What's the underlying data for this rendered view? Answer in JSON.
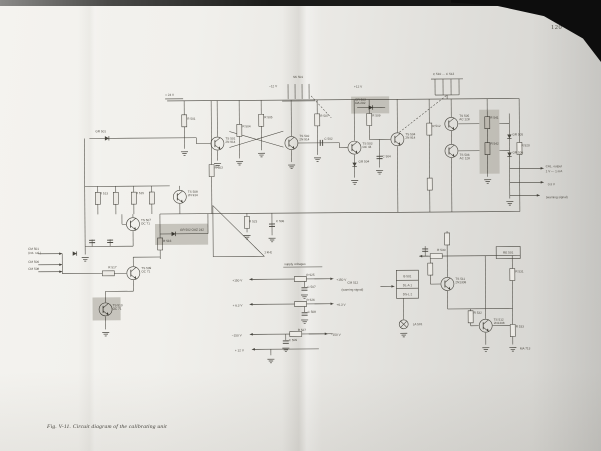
{
  "page_number": "120",
  "caption": "Fig. V-11. Circuit diagram of the calibrating unit",
  "colors": {
    "paper": "#eceae5",
    "ink": "#45433c",
    "label": "#4c4941",
    "highlight": "#b3b0a8"
  },
  "schematic": {
    "wires": [
      [
        168,
        100,
        520,
        100
      ],
      [
        185,
        100,
        185,
        148
      ],
      [
        212,
        100,
        212,
        213
      ],
      [
        240,
        100,
        240,
        158
      ],
      [
        262,
        100,
        262,
        150
      ],
      [
        292,
        100,
        292,
        136
      ],
      [
        292,
        150,
        292,
        162
      ],
      [
        318,
        100,
        318,
        155
      ],
      [
        355,
        100,
        355,
        141
      ],
      [
        355,
        155,
        355,
        178
      ],
      [
        370,
        100,
        370,
        140
      ],
      [
        370,
        140,
        391,
        140
      ],
      [
        398,
        100,
        398,
        133
      ],
      [
        398,
        147,
        398,
        213
      ],
      [
        430,
        100,
        430,
        213
      ],
      [
        452,
        100,
        452,
        118
      ],
      [
        452,
        132,
        452,
        145
      ],
      [
        452,
        159,
        452,
        213
      ],
      [
        488,
        100,
        488,
        112
      ],
      [
        488,
        112,
        488,
        178
      ],
      [
        520,
        100,
        520,
        213
      ],
      [
        218,
        100,
        218,
        136
      ],
      [
        218,
        150,
        218,
        160
      ],
      [
        197,
        137,
        197,
        143
      ],
      [
        197,
        143,
        211,
        143
      ],
      [
        90,
        137,
        197,
        137
      ],
      [
        85,
        137,
        85,
        253
      ],
      [
        230,
        131,
        284,
        147
      ],
      [
        230,
        147,
        284,
        131
      ],
      [
        298,
        143,
        340,
        143
      ],
      [
        340,
        143,
        340,
        148
      ],
      [
        340,
        148,
        348,
        148
      ],
      [
        380,
        140,
        380,
        168
      ],
      [
        459,
        125,
        480,
        125
      ],
      [
        459,
        152,
        480,
        152
      ],
      [
        500,
        125,
        510,
        125
      ],
      [
        500,
        152,
        510,
        152
      ],
      [
        510,
        115,
        510,
        200
      ],
      [
        289,
        84,
        289,
        99
      ],
      [
        296,
        84,
        296,
        99
      ],
      [
        303,
        84,
        303,
        99
      ],
      [
        310,
        84,
        310,
        99
      ],
      [
        283,
        101,
        316,
        101
      ],
      [
        432,
        80,
        464,
        80
      ],
      [
        436,
        80,
        436,
        96
      ],
      [
        444,
        80,
        444,
        96
      ],
      [
        452,
        80,
        452,
        96
      ],
      [
        460,
        80,
        460,
        96
      ],
      [
        436,
        96,
        460,
        96
      ],
      [
        448,
        96,
        448,
        100
      ],
      [
        166,
        98,
        184,
        98
      ],
      [
        358,
        108,
        386,
        108
      ],
      [
        160,
        213,
        520,
        213
      ],
      [
        85,
        185,
        170,
        185
      ],
      [
        98,
        185,
        98,
        213
      ],
      [
        116,
        185,
        116,
        213
      ],
      [
        134,
        185,
        134,
        213
      ],
      [
        152,
        185,
        152,
        213
      ],
      [
        180,
        185,
        180,
        189
      ],
      [
        180,
        203,
        180,
        213
      ],
      [
        122,
        213,
        122,
        223
      ],
      [
        122,
        223,
        126,
        223
      ],
      [
        133,
        213,
        133,
        216
      ],
      [
        133,
        230,
        133,
        245
      ],
      [
        85,
        245,
        133,
        245
      ],
      [
        92,
        238,
        92,
        245
      ],
      [
        110,
        238,
        110,
        245
      ],
      [
        160,
        213,
        160,
        258
      ],
      [
        160,
        233,
        208,
        233
      ],
      [
        208,
        213,
        208,
        233
      ],
      [
        133,
        256,
        133,
        265
      ],
      [
        133,
        256,
        160,
        256
      ],
      [
        100,
        272,
        126,
        272
      ],
      [
        62,
        252,
        62,
        272
      ],
      [
        62,
        272,
        100,
        272
      ],
      [
        133,
        279,
        133,
        290
      ],
      [
        105,
        290,
        133,
        290
      ],
      [
        105,
        290,
        105,
        301
      ],
      [
        105,
        315,
        105,
        328
      ],
      [
        247,
        213,
        247,
        232
      ],
      [
        272,
        213,
        272,
        235
      ],
      [
        250,
        279,
        332,
        279
      ],
      [
        250,
        304,
        332,
        304
      ],
      [
        250,
        334,
        332,
        334
      ],
      [
        252,
        349,
        318,
        349
      ],
      [
        304,
        279,
        304,
        287
      ],
      [
        304,
        304,
        304,
        312
      ],
      [
        285,
        334,
        285,
        340
      ],
      [
        270,
        349,
        270,
        355
      ],
      [
        283,
        267,
        322,
        267
      ],
      [
        396,
        281,
        418,
        281
      ],
      [
        396,
        289,
        418,
        289
      ],
      [
        403,
        299,
        403,
        320
      ],
      [
        420,
        257,
        520,
        257
      ],
      [
        447,
        232,
        447,
        257
      ],
      [
        447,
        257,
        447,
        278
      ],
      [
        447,
        292,
        447,
        310
      ],
      [
        447,
        310,
        512,
        310
      ],
      [
        430,
        257,
        430,
        285
      ],
      [
        430,
        285,
        440,
        285
      ],
      [
        485,
        257,
        485,
        320
      ],
      [
        485,
        334,
        485,
        346
      ],
      [
        470,
        310,
        470,
        327
      ],
      [
        470,
        327,
        478,
        327
      ],
      [
        492,
        327,
        512,
        327
      ],
      [
        512,
        257,
        512,
        346
      ],
      [
        425,
        247,
        425,
        257
      ]
    ],
    "dashes": [
      [
        312,
        96,
        332,
        118
      ],
      [
        400,
        133,
        448,
        96
      ]
    ],
    "arrows": [
      [
        38,
        252,
        62,
        252
      ],
      [
        38,
        263,
        62,
        263
      ],
      [
        38,
        270,
        62,
        270
      ],
      [
        510,
        170,
        544,
        170
      ],
      [
        510,
        184,
        544,
        184
      ],
      [
        510,
        197,
        540,
        197
      ],
      [
        268,
        279,
        249,
        279
      ],
      [
        268,
        304,
        249,
        304
      ],
      [
        268,
        334,
        249,
        334
      ],
      [
        264,
        349,
        251,
        349
      ],
      [
        314,
        279,
        333,
        279
      ],
      [
        314,
        304,
        333,
        304
      ],
      [
        308,
        334,
        327,
        334
      ],
      [
        380,
        287,
        394,
        287
      ],
      [
        428,
        257,
        419,
        257
      ]
    ],
    "resistors": [
      [
        185,
        120,
        "v"
      ],
      [
        212,
        170,
        "v"
      ],
      [
        240,
        130,
        "v"
      ],
      [
        262,
        120,
        "v"
      ],
      [
        318,
        120,
        "v"
      ],
      [
        370,
        120,
        "v"
      ],
      [
        430,
        130,
        "v"
      ],
      [
        430,
        185,
        "v"
      ],
      [
        488,
        124,
        "v"
      ],
      [
        488,
        150,
        "v"
      ],
      [
        520,
        150,
        "v"
      ],
      [
        98,
        197,
        "v"
      ],
      [
        116,
        197,
        "v"
      ],
      [
        134,
        197,
        "v"
      ],
      [
        152,
        197,
        "v"
      ],
      [
        160,
        243,
        "v"
      ],
      [
        108,
        272,
        "h"
      ],
      [
        300,
        279,
        "h"
      ],
      [
        300,
        304,
        "h"
      ],
      [
        295,
        334,
        "h"
      ],
      [
        436,
        257,
        "h"
      ],
      [
        430,
        270,
        "v"
      ],
      [
        447,
        240,
        "v"
      ],
      [
        470,
        318,
        "v"
      ],
      [
        512,
        276,
        "v"
      ],
      [
        512,
        332,
        "v"
      ],
      [
        247,
        222,
        "v"
      ]
    ],
    "caps": [
      [
        322,
        143,
        "h"
      ],
      [
        380,
        158,
        "v"
      ],
      [
        272,
        225,
        "v"
      ],
      [
        92,
        240,
        "v"
      ],
      [
        110,
        240,
        "v"
      ],
      [
        304,
        289,
        "v"
      ],
      [
        304,
        314,
        "v"
      ],
      [
        285,
        342,
        "v"
      ],
      [
        425,
        251,
        "v"
      ]
    ],
    "diodes": [
      [
        108,
        137,
        "r"
      ],
      [
        372,
        108,
        "r"
      ],
      [
        355,
        165,
        "d"
      ],
      [
        510,
        138,
        "d"
      ],
      [
        510,
        156,
        "d"
      ],
      [
        174,
        233,
        "r"
      ],
      [
        75,
        252,
        "r"
      ]
    ],
    "transistors": [
      [
        218,
        143
      ],
      [
        292,
        143
      ],
      [
        355,
        148
      ],
      [
        398,
        140
      ],
      [
        452,
        125
      ],
      [
        452,
        152
      ],
      [
        133,
        223
      ],
      [
        180,
        196
      ],
      [
        133,
        272
      ],
      [
        105,
        308
      ],
      [
        447,
        285
      ],
      [
        485,
        327
      ]
    ],
    "grounds": [
      [
        185,
        151
      ],
      [
        218,
        163
      ],
      [
        240,
        161
      ],
      [
        262,
        153
      ],
      [
        292,
        165
      ],
      [
        318,
        158
      ],
      [
        355,
        181
      ],
      [
        380,
        171
      ],
      [
        488,
        181
      ],
      [
        510,
        203
      ],
      [
        85,
        256
      ],
      [
        105,
        331
      ],
      [
        247,
        235
      ],
      [
        272,
        238
      ],
      [
        304,
        295
      ],
      [
        304,
        320
      ],
      [
        285,
        348
      ],
      [
        270,
        359
      ],
      [
        403,
        334
      ],
      [
        485,
        349
      ],
      [
        512,
        349
      ]
    ],
    "lamps": [
      [
        403,
        325
      ]
    ],
    "boxes": [
      [
        396,
        271,
        22,
        28
      ],
      [
        496,
        248,
        24,
        12
      ]
    ],
    "triangle": "213,205 213,256 264,256",
    "highlights": [
      [
        352,
        97,
        38,
        17
      ],
      [
        480,
        111,
        20,
        64
      ],
      [
        155,
        223,
        53,
        21
      ],
      [
        92,
        296,
        28,
        23
      ]
    ],
    "labels": [
      [
        166,
        95,
        "+ 24 V"
      ],
      [
        96,
        131,
        "GR 501"
      ],
      [
        294,
        78,
        "SK 501"
      ],
      [
        270,
        87,
        "−12 V"
      ],
      [
        355,
        88,
        "+12 V"
      ],
      [
        434,
        76,
        "C 510 … C 513"
      ],
      [
        226,
        139,
        "TS 501\n2N 914"
      ],
      [
        300,
        137,
        "TS 502\n2N 914"
      ],
      [
        363,
        145,
        "TS 503\nOC 44"
      ],
      [
        406,
        136,
        "TS 504\n2N 914"
      ],
      [
        460,
        118,
        "TS 505\nAC 128"
      ],
      [
        460,
        157,
        "TS 506\nAC 128"
      ],
      [
        141,
        220,
        "TS 507\nOC 71"
      ],
      [
        188,
        192,
        "TS 508\n2N 914"
      ],
      [
        141,
        268,
        "TS 509\nOC 71"
      ],
      [
        112,
        305,
        "TS 510\nOC 71"
      ],
      [
        455,
        281,
        "TS 511\n2N1308"
      ],
      [
        493,
        322,
        "TS 512\n2N1308"
      ],
      [
        356,
        101,
        "GR 503\nOA 202"
      ],
      [
        180,
        230,
        "GR 502  OAZ 242"
      ],
      [
        513,
        137,
        "GR 505"
      ],
      [
        513,
        155,
        "GR 506"
      ],
      [
        359,
        163,
        "GR 504"
      ],
      [
        188,
        119,
        "R 501"
      ],
      [
        215,
        168,
        "R 503"
      ],
      [
        243,
        127,
        "R 504"
      ],
      [
        265,
        118,
        "R 505"
      ],
      [
        321,
        117,
        "R 507"
      ],
      [
        373,
        117,
        "R 509"
      ],
      [
        433,
        128,
        "R 512"
      ],
      [
        522,
        148,
        "R 520"
      ],
      [
        100,
        193,
        "R 513"
      ],
      [
        136,
        193,
        "R 515"
      ],
      [
        163,
        241,
        "R 516"
      ],
      [
        108,
        267,
        "R 517"
      ],
      [
        306,
        276,
        "R 525"
      ],
      [
        306,
        301,
        "R 526"
      ],
      [
        297,
        331,
        "R 527"
      ],
      [
        437,
        252,
        "R 530"
      ],
      [
        515,
        274,
        "R 531"
      ],
      [
        473,
        315,
        "R 532"
      ],
      [
        515,
        329,
        "R 533"
      ],
      [
        325,
        140,
        "C 502"
      ],
      [
        383,
        158,
        "C 504"
      ],
      [
        276,
        222,
        "C 506"
      ],
      [
        249,
        222,
        "R 523"
      ],
      [
        307,
        288,
        "C 507"
      ],
      [
        307,
        313,
        "C 508"
      ],
      [
        288,
        341,
        "C 509"
      ],
      [
        28,
        248,
        "CM 501"
      ],
      [
        28,
        252,
        "(ext. cal.)"
      ],
      [
        28,
        261,
        "CM 506"
      ],
      [
        28,
        268,
        "CM 508"
      ],
      [
        232,
        281,
        "+150 V"
      ],
      [
        232,
        306,
        "+ 6.3 V"
      ],
      [
        231,
        336,
        "−150 V"
      ],
      [
        234,
        351,
        "+ 12 V"
      ],
      [
        336,
        281,
        "+150 V"
      ],
      [
        336,
        306,
        "+6.3 V"
      ],
      [
        330,
        336,
        "−150 V"
      ],
      [
        284,
        265,
        "supply voltages"
      ],
      [
        347,
        284,
        "CM 512"
      ],
      [
        341,
        291,
        "(warning signal)"
      ],
      [
        407,
        278,
        "B 501",
        "m"
      ],
      [
        407,
        287,
        "DL-A 1",
        "m"
      ],
      [
        407,
        296,
        "DS-L 2",
        "m"
      ],
      [
        412,
        326,
        "LA 501"
      ],
      [
        546,
        169,
        "CAL. output"
      ],
      [
        546,
        174,
        "1 V — 1 mA"
      ],
      [
        548,
        187,
        "0.3 V"
      ],
      [
        546,
        200,
        "(warning signal)"
      ],
      [
        519,
        351,
        "MA 713"
      ],
      [
        264,
        253,
        "1 kHz"
      ],
      [
        491,
        120,
        "R 541"
      ],
      [
        491,
        146,
        "R 542"
      ],
      [
        508,
        255,
        "RE 501",
        "m"
      ]
    ]
  }
}
